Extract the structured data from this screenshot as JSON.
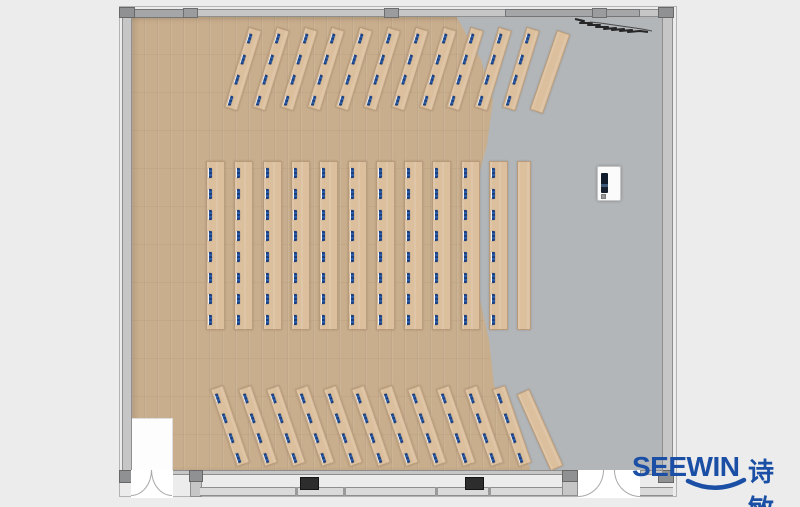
{
  "canvas": {
    "width": 800,
    "height": 507
  },
  "palette": {
    "bg": "#ececec",
    "wood": "#c9ae8d",
    "desk": "#dcc09e",
    "concrete": "#b2b6b9",
    "wall_fill": "#c6c6c6",
    "wall_edge": "#8e8e8e",
    "pier": "#a4a6a8",
    "black_pier": "#2d2d2d",
    "seat_blue": "#2b5ca8",
    "seat_dark": "#1d3f7d",
    "logo_blue": "#1a4fa5"
  },
  "logo": {
    "brand": "SEEWIN",
    "brand_cn": "诗敏"
  },
  "plan": {
    "middle_block": {
      "columns": 11,
      "seats_per_column": 8,
      "first_x": 206,
      "spacing": 28.3,
      "col_width": 19,
      "top_y": 161,
      "col_height": 169,
      "seat_first_y": 6,
      "seat_spacing": 21
    },
    "middle_side_strip": {
      "x": 517,
      "y": 161,
      "width": 14,
      "height": 169
    },
    "top_group": {
      "strips": 11,
      "seats_per_strip": 4,
      "first_center_x": 243,
      "spacing": 27.8,
      "center_y": 69,
      "width": 14,
      "height": 84,
      "angle": 17,
      "seat_first_y": 5,
      "seat_spacing": 21.5,
      "bare_strip": {
        "center_x": 550,
        "center_y": 72,
        "angle": 19,
        "width": 14,
        "height": 84
      }
    },
    "bottom_group": {
      "strips": 11,
      "seats_per_strip": 4,
      "first_center_x": 230,
      "spacing": 28.2,
      "center_y": 426,
      "width": 14,
      "height": 82,
      "angle": -19,
      "seat_first_y": 5,
      "seat_spacing": 21,
      "bare_strip": {
        "center_x": 540,
        "center_y": 430,
        "angle": -24,
        "width": 14,
        "height": 84
      }
    }
  }
}
